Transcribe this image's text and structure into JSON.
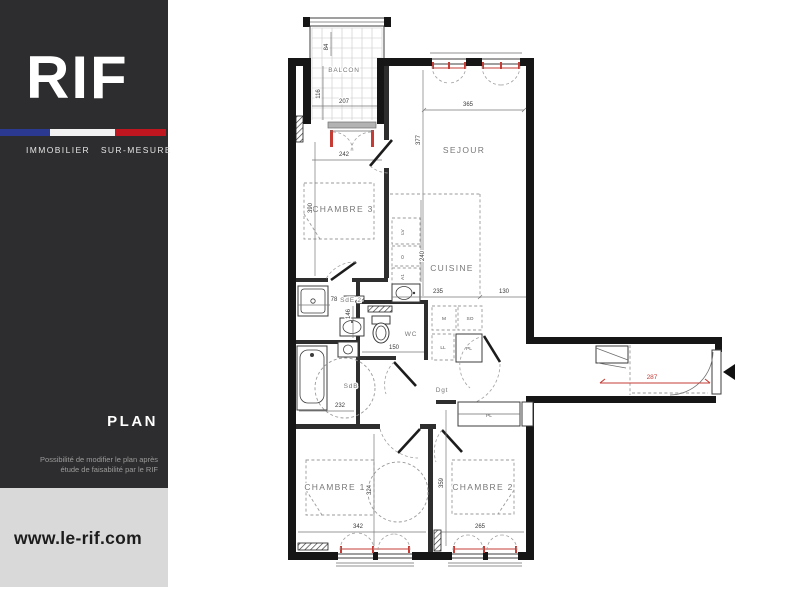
{
  "sidebar": {
    "logo_text": "RIF",
    "logo_subtitle": "IMMOBILIER SUR-MESURE",
    "section_label": "PLAN",
    "note_line1": "Possibilité de modifier le plan après",
    "note_line2": "étude de faisabilité par le RIF",
    "website": "www.le-rif.com",
    "colors": {
      "panel": "#2d2d2f",
      "flag_blue": "#2b3a90",
      "flag_white": "#f2f2f2",
      "flag_red": "#c0161f",
      "band": "#d9d9d9"
    }
  },
  "plan": {
    "labels": {
      "balcon": "BALCON",
      "sejour": "SEJOUR",
      "chambre3": "CHAMBRE 3",
      "cuisine": "CUISINE",
      "sde2": "SdE 2",
      "wc": "WC",
      "sdb": "SdB",
      "dgt": "Dgt",
      "chambre1": "CHAMBRE 1",
      "chambre2": "CHAMBRE 2",
      "placard": "PL"
    },
    "dims": {
      "balcon_depth_upper": "84",
      "balcon_depth": "116",
      "balcon_width": "207",
      "chambre3_door": "242",
      "chambre3_height": "390",
      "sejour_width": "365",
      "sejour_height": "377",
      "cuisine_width": "235",
      "cuisine_right": "130",
      "cuisine_column": "240",
      "sde2_width": "78",
      "sde2_height": "146",
      "wc_width": "150",
      "sdb_width": "232",
      "entry_width": "287",
      "chambre1_height": "324",
      "chambre1_width": "342",
      "chambre2_height": "359",
      "chambre2_width": "265"
    },
    "appliances": {
      "lv": "LV",
      "oven": "O",
      "a1": "A1",
      "micro": "M",
      "so": "SO",
      "ll": "LL",
      "pl": "PL"
    },
    "accent_color": "#c63c35"
  }
}
